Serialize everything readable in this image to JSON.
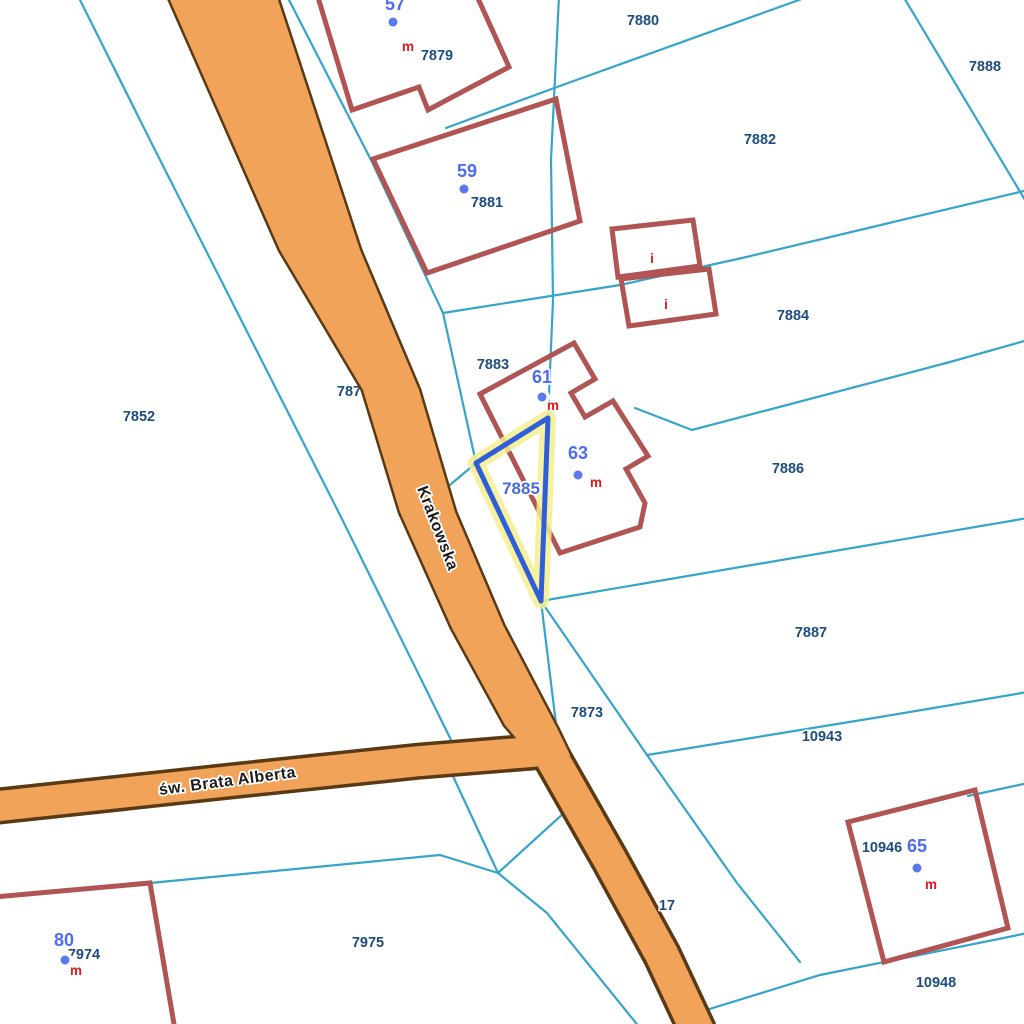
{
  "title": "Cadastral map viewer",
  "colors": {
    "background": "#ffffff",
    "boundary": "#35a5c9",
    "road_fill": "#f0a359",
    "road_border": "#5a3a14",
    "building_outline": "#b05454",
    "parcel_label": "#1d4d7f",
    "building_number": "#4d6cf0",
    "use_letter": "#e01818",
    "dot": "#5b79ef",
    "highlight_halo": "#f5ef8f",
    "highlight_stroke": "#2e5ed8",
    "selected_label": "#4a6bd9",
    "street_label": "#1c1c1c"
  },
  "streets": {
    "krakowska": "Krakowska",
    "brata_alberta": "św. Brata Alberta"
  },
  "selected_parcel": "7885",
  "parcels": {
    "p7880": "7880",
    "p7888": "7888",
    "p7882": "7882",
    "p7879": "7879",
    "p7881": "7881",
    "p7884": "7884",
    "p7883": "7883",
    "p7852": "7852",
    "p7886": "7886",
    "p7887": "7887",
    "p7873": "7873",
    "p10943": "10943",
    "p10946": "10946",
    "p10948": "10948",
    "p7974": "7974",
    "p7975": "7975",
    "partial_road": "787",
    "partial_17": "17"
  },
  "buildings": {
    "n57": "57",
    "n59": "59",
    "n61": "61",
    "n63": "63",
    "n65": "65",
    "n80": "80",
    "letter_m": "m",
    "letter_i": "i"
  }
}
